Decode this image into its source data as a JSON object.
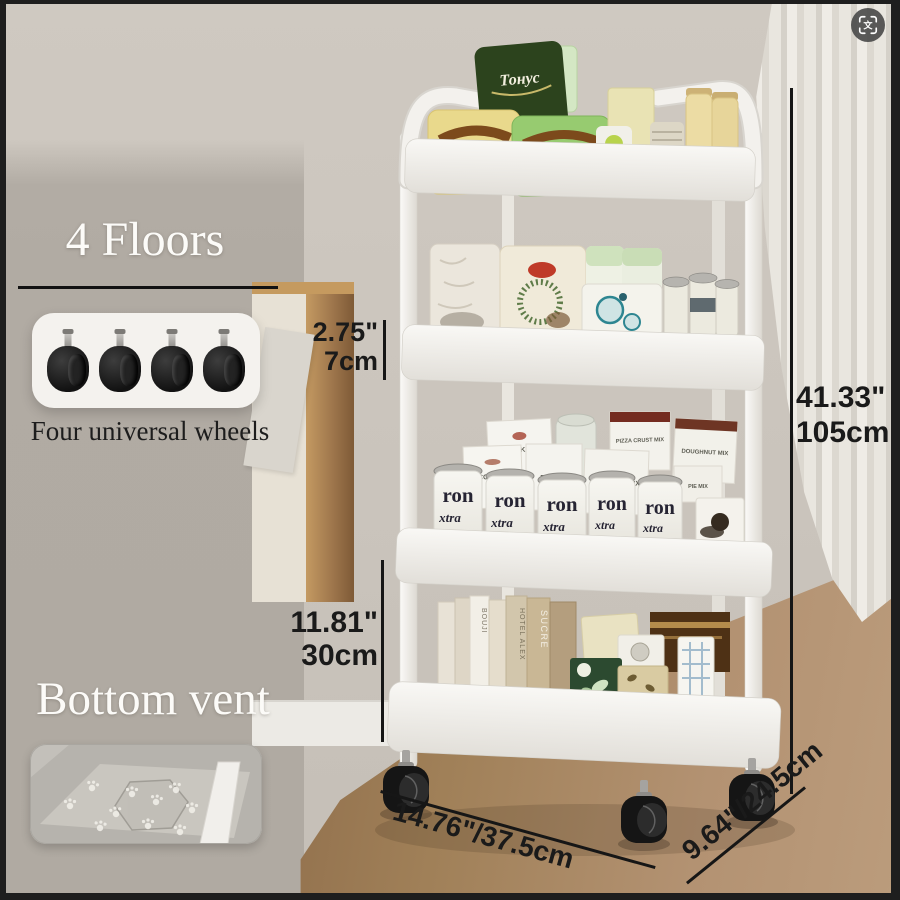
{
  "left_panels": {
    "floors_title": "4 Floors",
    "wheels_caption": "Four universal wheels",
    "vent_title": "Bottom vent"
  },
  "dims": {
    "tier_gap_in": "2.75\"",
    "tier_gap_cm": "7cm",
    "height_in": "41.33\"",
    "height_cm": "105cm",
    "bottom_in": "11.81\"",
    "bottom_cm": "30cm",
    "width": "14.76\"/37.5cm",
    "depth": "9.64\"/24.5cm"
  },
  "products": {
    "bag_script": "Тонус",
    "mix_boxes": [
      "PANCAKE MIX",
      "SCONE MIX",
      "PIE MIX",
      "BROWNIE MIX",
      "PIZZA CRUST MIX",
      "DOUGHNUT MIX"
    ],
    "can_top": "ron",
    "can_bottom": "xtra",
    "book_spines": [
      "HOTEL ALEX",
      "SUCRE",
      "BOUJI"
    ]
  },
  "translate": {
    "glyph": "文"
  },
  "colors": {
    "dimension_ink": "#1a1a1a",
    "heading_white": "#fcfbf8",
    "cart_white": "#f2f0ec",
    "caster_black": "#151515",
    "wall_beige": "#cbc5bd",
    "overlay_gray": "#b1aba3",
    "floor_wood": "#8a6847",
    "cabinet_wood": "#b5854e",
    "curtain_white": "#e9e6df"
  }
}
